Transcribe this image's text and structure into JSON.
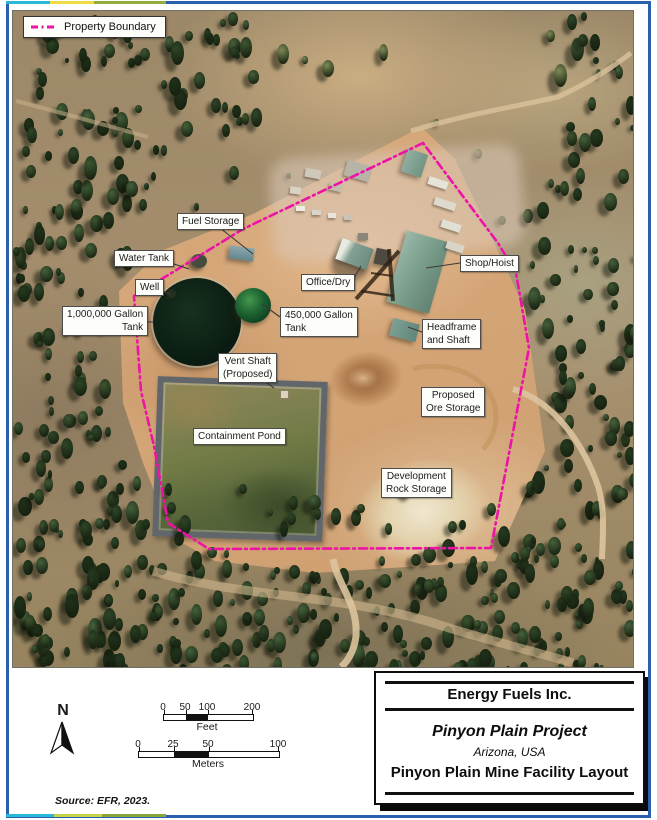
{
  "legend": {
    "property_boundary": "Property Boundary"
  },
  "boundary": {
    "color": "#ee13a7"
  },
  "map_labels": {
    "fuel_storage": "Fuel Storage",
    "water_tank": "Water Tank",
    "well": "Well",
    "tank_1m": {
      "line1": "1,000,000 Gallon",
      "line2": "Tank"
    },
    "office_dry": "Office/Dry",
    "tank_450k": {
      "line1": "450,000 Gallon",
      "line2": "Tank"
    },
    "shop_hoist": "Shop/Hoist",
    "headframe": {
      "line1": "Headframe",
      "line2": "and Shaft"
    },
    "vent_shaft": {
      "line1": "Vent Shaft",
      "line2": "(Proposed)"
    },
    "ore_storage": {
      "line1": "Proposed",
      "line2": "Ore Storage"
    },
    "containment_pond": "Containment Pond",
    "rock_storage": {
      "line1": "Development",
      "line2": "Rock Storage"
    }
  },
  "compass": {
    "north": "N"
  },
  "scales": {
    "feet": {
      "t0": "0",
      "t1": "50",
      "t2": "100",
      "t3": "200",
      "unit": "Feet"
    },
    "meters": {
      "t0": "0",
      "t1": "25",
      "t2": "50",
      "t3": "100",
      "unit": "Meters"
    }
  },
  "title_block": {
    "company": "Energy Fuels Inc.",
    "project": "Pinyon Plain Project",
    "location": "Arizona, USA",
    "map_title": "Pinyon Plain Mine Facility Layout"
  },
  "source_note": "Source:  EFR, 2023."
}
